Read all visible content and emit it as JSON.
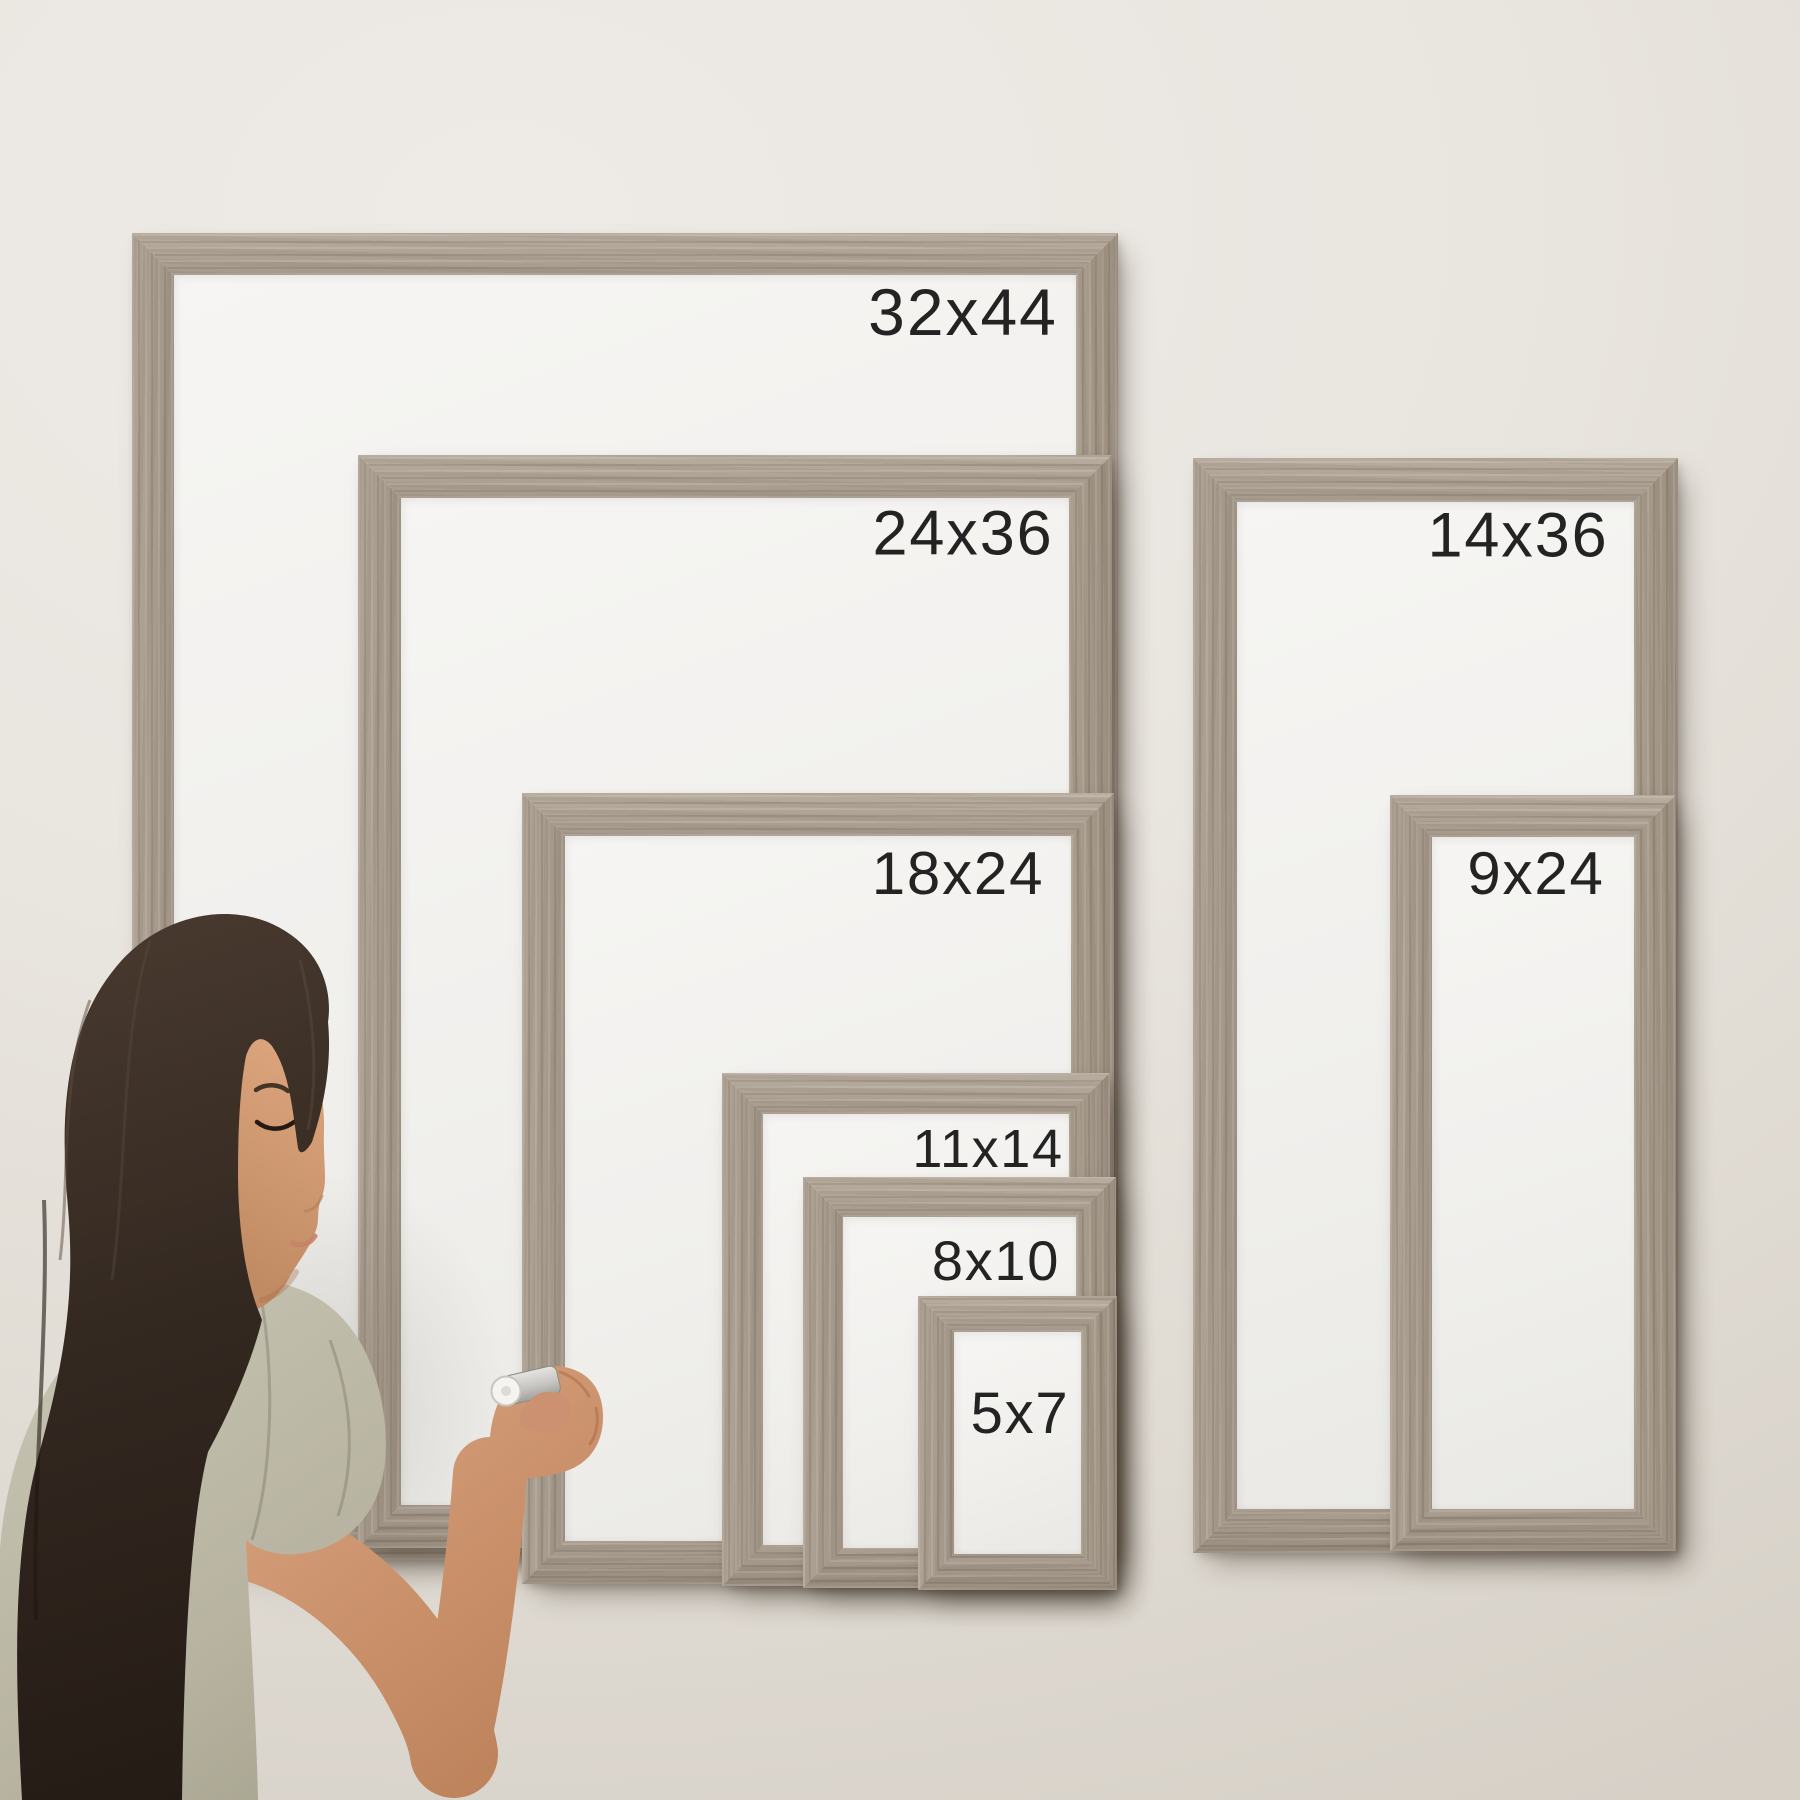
{
  "frames": [
    {
      "id": "32x44",
      "label": "32x44",
      "group": "left"
    },
    {
      "id": "24x36",
      "label": "24x36",
      "group": "left"
    },
    {
      "id": "18x24",
      "label": "18x24",
      "group": "left"
    },
    {
      "id": "11x14",
      "label": "11x14",
      "group": "left"
    },
    {
      "id": "8x10",
      "label": "8x10",
      "group": "left"
    },
    {
      "id": "5x7",
      "label": "5x7",
      "group": "left"
    },
    {
      "id": "14x36",
      "label": "14x36",
      "group": "right"
    },
    {
      "id": "9x24",
      "label": "9x24",
      "group": "right"
    }
  ],
  "colors": {
    "wall": "#e8e4de",
    "frame_wood": "#a99d8f",
    "frame_wood_light": "#bcb0a2",
    "frame_wood_dark": "#8d8174",
    "whiteboard": "#f1f0ed",
    "label_text": "#232323",
    "hair": "#352a22",
    "skin": "#cf9774",
    "shirt": "#bcb8a6",
    "marker_cap": "#f5f4f1"
  }
}
